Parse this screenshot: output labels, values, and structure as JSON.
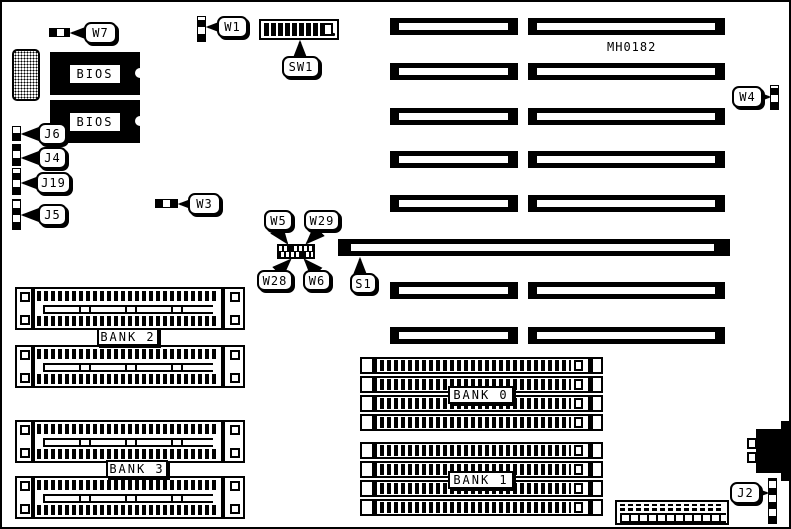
{
  "board": {
    "part_number": "MH0182"
  },
  "chips": {
    "bios1": "BIOS",
    "bios2": "BIOS"
  },
  "banks": {
    "bank0": "BANK 0",
    "bank1": "BANK 1",
    "bank2": "BANK 2",
    "bank3": "BANK 3"
  },
  "callouts": {
    "w7": "W7",
    "w1": "W1",
    "sw1": "SW1",
    "j6": "J6",
    "j4": "J4",
    "j19": "J19",
    "j5": "J5",
    "w3": "W3",
    "w5": "W5",
    "w29": "W29",
    "w28": "W28",
    "w6": "W6",
    "s1": "S1",
    "w4": "W4",
    "j2": "J2"
  },
  "colors": {
    "ink": "#000000",
    "background": "#ffffff"
  }
}
